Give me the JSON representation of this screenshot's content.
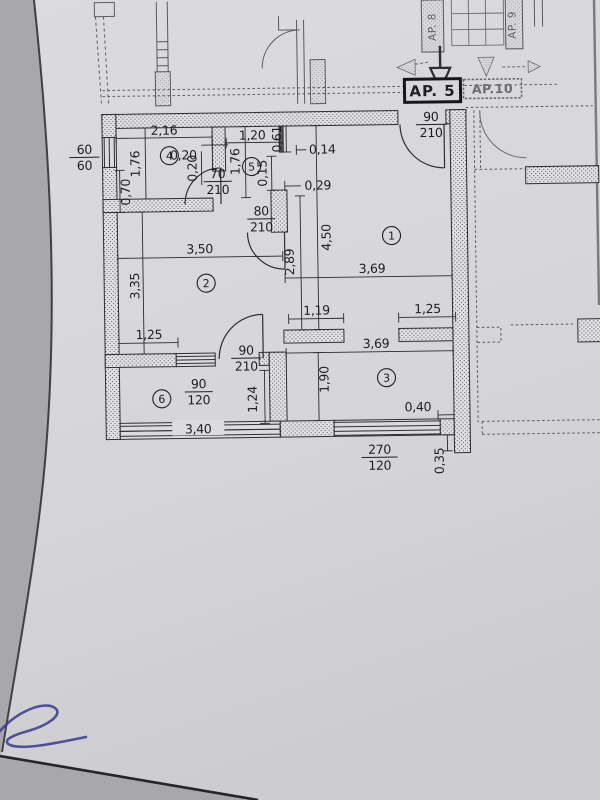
{
  "plan": {
    "apartment_main": "AP. 5",
    "apartment_right": "AP.10",
    "apartment_top_left_vertical": "AP. 8",
    "apartment_top_right_vertical": "AP. 9",
    "rooms": {
      "r1": "1",
      "r2": "2",
      "r3": "3",
      "r4": "4",
      "r5": "5",
      "r6": "6"
    },
    "openings": {
      "entry_door": {
        "num": "90",
        "den": "210"
      },
      "door_70": {
        "num": "70",
        "den": "210"
      },
      "door_80": {
        "num": "80",
        "den": "210"
      },
      "door_90_room": {
        "num": "90",
        "den": "210"
      },
      "window_60": {
        "num": "60",
        "den": "60"
      },
      "window_90": {
        "num": "90",
        "den": "120"
      },
      "window_270": {
        "num": "270",
        "den": "120"
      }
    },
    "dims": {
      "d216": "2,16",
      "d020a": "0,20",
      "d020b": "0,20",
      "d120": "1,20",
      "d061": "0,61",
      "d014": "0,14",
      "d176l": "1,76",
      "d176r": "1,76",
      "d015": "0,15",
      "d029": "0,29",
      "d070": "0,70",
      "d450": "4,50",
      "d289": "2,89",
      "d350": "3,50",
      "d369a": "3,69",
      "d335": "3,35",
      "d119": "1,19",
      "d125r": "1,25",
      "d125l": "1,25",
      "d369b": "3,69",
      "d190": "1,90",
      "d124": "1,24",
      "d040": "0,40",
      "d340": "3,40",
      "d035": "0,35"
    },
    "colors": {
      "ink": "#2e2e33",
      "pen": "#3c3e8f",
      "paper": "#d8d8da"
    }
  }
}
